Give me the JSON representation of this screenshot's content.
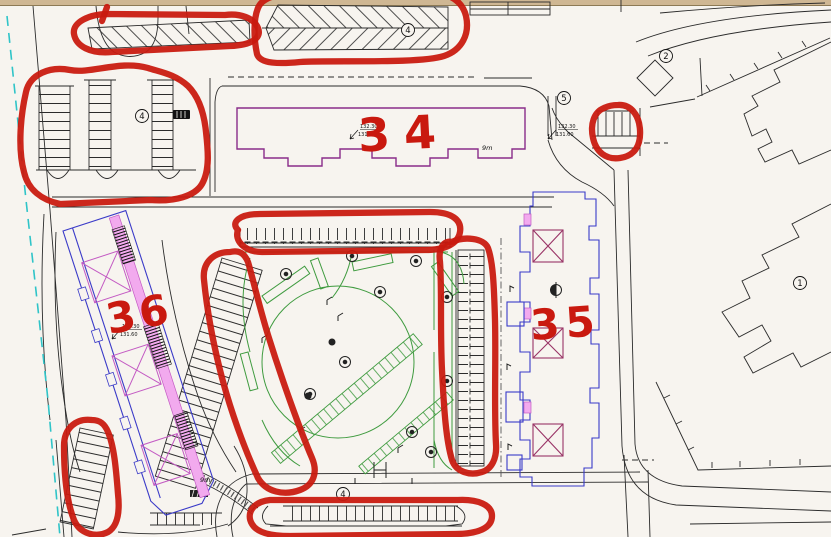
{
  "drawing_type": "architectural site plan with red marker annotations",
  "palette": {
    "paper": "#f7f4ef",
    "marker_red": "#c9190f",
    "building34_purple": "#8a2c8a",
    "building_blue": "#3a3ac8",
    "core_magenta": "#c35ac3",
    "core_maroon": "#993366",
    "wall_pink": "#f2aaee",
    "landscape_green": "#3f9b3f",
    "boundary_cyan": "#2fc4c8",
    "frame_tan": "#cfb793",
    "line_black": "#2b2b2b"
  },
  "marker_labels": {
    "b34": "34",
    "b35": "35",
    "b36": "36"
  },
  "ref_numbers": {
    "east_building": "1",
    "ne_structure": "2",
    "nw_lot": "4",
    "north_strip": "4",
    "south_row": "4",
    "east_road": "5"
  },
  "dimensions": {
    "d34": "9m",
    "d36": "9m"
  },
  "elevation": {
    "upper": "132.30",
    "lower": "131.60"
  },
  "circled_regions": [
    "nw-hatched-strip",
    "north-hatched-strip",
    "nw-parking-lot",
    "center-north-parking-row",
    "center-diagonal-parking",
    "center-east-parking",
    "east-mini-parking",
    "sw-small-parking",
    "south-parking-row"
  ]
}
